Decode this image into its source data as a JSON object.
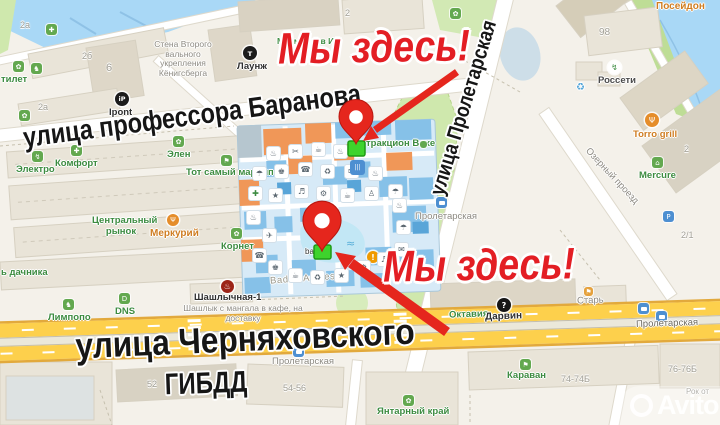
{
  "annotations": {
    "we_are_here_1": "Мы здесь!",
    "we_are_here_2": "Мы здесь!"
  },
  "big_labels": {
    "baranova": "улица профессора Баранова",
    "proletarskaya": "улица Пролетарская",
    "chernyahovskogo": "улица Черняховского",
    "gibdd": "ГИБДД"
  },
  "streets": {
    "ozerny_proezd": "Озерный проезд"
  },
  "transit_stops": {
    "stop_mall": "Пролетарская",
    "stop_road_center": "Пролетарская",
    "stop_road_right": "Пролетарская"
  },
  "pois": {
    "stena": "Стена Второго вального укрепления Кёнигсберга",
    "ipont": "Ipont",
    "t_lounge": "Лаунж",
    "my_mamy": "Мы мамы в И",
    "tilet": "тилет",
    "poseidon": "Посейдон",
    "rosseti": "Россети",
    "torro_grill": "Torro grill",
    "mercure": "Mercure",
    "elektro": "Электро",
    "komfort": "Комфорт",
    "elen": "Элен",
    "tot_samy_marcipan": "Тот самый марципан",
    "rynok": "Центральный рынок",
    "merkuriy": "Меркурий",
    "kornet": "Корнет",
    "dachnika": "ь дачника",
    "limpopo": "Лимпопо",
    "dns": "DNS",
    "shashlychnaya_title": "Шашлычная-1",
    "shashlychnaya_sub": "Шашлык с мангала в кафе, на доставку",
    "attrakcion": "тракцион Вохе",
    "bali": "bali",
    "baden_amnesia": "Baden Amnesia",
    "oktavia": "Октавия",
    "darvin": "Дарвин",
    "star": "Старь",
    "karavan": "Караван",
    "yantarny_kray": "Янтарный край",
    "rokot": "Рок от"
  },
  "building_numbers": {
    "b2a_1": "2а",
    "b2a_2": "2а",
    "b2b": "2б",
    "b6": "6",
    "b2_top": "2",
    "b98": "98",
    "b2_right": "2",
    "b2_1": "2/1",
    "b52": "52",
    "b54_56": "54-56",
    "b74_74b": "74-74Б",
    "b76_76b": "76-76Б"
  },
  "icons": {
    "ipont": "iP",
    "t_lounge": "т",
    "darvin": "?",
    "dns": "D",
    "parking": "P",
    "fork": "Ψ",
    "bolt": "↯",
    "home": "⌂",
    "kebab": "♨",
    "plus": "✚",
    "flower": "✿",
    "paw": "♞",
    "bag": "⚑",
    "recycle": "♻"
  },
  "mall_icons": [
    "♨",
    "✂",
    "☕",
    "♨",
    "☂",
    "♚",
    "☎",
    "♻",
    "✉",
    "♨",
    "✚",
    "★",
    "♬",
    "⚙",
    "☕",
    "♙",
    "☂",
    "♨",
    "✈",
    "☎",
    "♚",
    "☕",
    "♻",
    "★",
    "⚙",
    "♬",
    "✉",
    "☂",
    "♨",
    "|||",
    "≈",
    "≈"
  ],
  "watermark": {
    "brand": "Avito"
  },
  "colors": {
    "accent_red": "#e31e24",
    "marker_green": "#3ed32c",
    "road_yellow": "#fdd04c",
    "water": "#a9d8f6",
    "park_green": "#cfe8ad"
  }
}
